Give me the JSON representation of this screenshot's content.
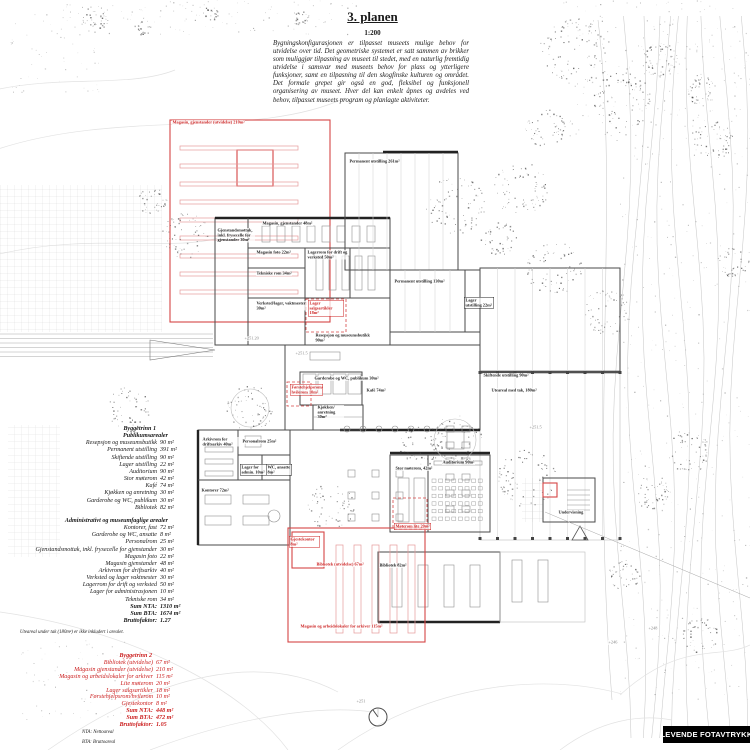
{
  "header": {
    "title": "3. planen",
    "scale": "1:200",
    "description": "Bygningskonfigurasjonen er tilpasset museets mulige behov for utvidelse over tid. Det geometriske systemet er satt sammen av brikker som muliggjør tilpasning av museet til stedet, med en naturlig fremtidig utvidelse i samsvar med museets behov for plass og ytterligere funksjoner, samt en tilpasning til den skogfinske kulturen og området. Det formale grepet gir også en god, fleksibel og funksjonell organisering av museet. Hver del kan enkelt åpnes og avdeles ved behov, tilpasset museets program og planlagte aktiviteter."
  },
  "program": {
    "phase1": {
      "title": "Byggetrinn 1",
      "sections": [
        {
          "heading": "Publikumsarealer",
          "items": [
            {
              "label": "Resepsjon og museumsbutikk",
              "area": "90 m²"
            },
            {
              "label": "Permanent utstilling",
              "area": "391 m²"
            },
            {
              "label": "Skiftende utstilling",
              "area": "90 m²"
            },
            {
              "label": "Lager utstilling",
              "area": "22 m²"
            },
            {
              "label": "Auditorium",
              "area": "90 m²"
            },
            {
              "label": "Stor møterom",
              "area": "42 m²"
            },
            {
              "label": "Kafé",
              "area": "74 m²"
            },
            {
              "label": "Kjøkken og anretning",
              "area": "30 m²"
            },
            {
              "label": "Garderobe og WC, publikum",
              "area": "30 m²"
            },
            {
              "label": "Bibliotek",
              "area": "82 m²"
            }
          ]
        },
        {
          "heading": "Administrativt og museumfaglige arealer",
          "items": [
            {
              "label": "Kontorer, fast",
              "area": "72 m²"
            },
            {
              "label": "Garderobe og WC, ansatte",
              "area": "8 m²"
            },
            {
              "label": "Personalrom",
              "area": "25 m²"
            },
            {
              "label": "Gjenstandsmottak, inkl. frysecelle for gjenstander",
              "area": "30 m²"
            },
            {
              "label": "Magasin foto",
              "area": "22 m²"
            },
            {
              "label": "Magasin gjenstander",
              "area": "48 m²"
            },
            {
              "label": "Arkivrom for driftsarkiv",
              "area": "40 m²"
            },
            {
              "label": "Verksted og lager vaktmester",
              "area": "30 m²"
            },
            {
              "label": "Lagerrom for drift og verksted",
              "area": "50 m²"
            },
            {
              "label": "Lager for administrasjonen",
              "area": "10 m²"
            },
            {
              "label": "Tekniske rom",
              "area": "34 m²"
            }
          ]
        }
      ],
      "totals": [
        {
          "label": "Sum NTA:",
          "area": "1310 m²"
        },
        {
          "label": "Sum BTA:",
          "area": "1674 m²"
        },
        {
          "label": "Bruttofaktor:",
          "area": "1.27"
        }
      ],
      "note": "Uteareal under tak (180m²) er ikke inkludert i arealet."
    },
    "phase2": {
      "title": "Byggetrinn 2",
      "items": [
        {
          "label": "Bibliotek (utvidelse)",
          "area": "67 m²"
        },
        {
          "label": "Magasin gjenstander (utvidelse)",
          "area": "210 m²"
        },
        {
          "label": "Magasin og arbeidslokaler for arkiver",
          "area": "115 m²"
        },
        {
          "label": "Lite møterom",
          "area": "20 m²"
        },
        {
          "label": "Lager salgsartikler",
          "area": "18 m²"
        },
        {
          "label": "Førstehjelpsrom/hvilerom",
          "area": "10 m²"
        },
        {
          "label": "Gjestekontor",
          "area": "8 m²"
        }
      ],
      "totals": [
        {
          "label": "Sum NTA:",
          "area": "448 m²"
        },
        {
          "label": "Sum BTA:",
          "area": "472 m²"
        },
        {
          "label": "Bruttofaktor:",
          "area": "1.05"
        }
      ]
    },
    "abbreviations": [
      "NTA: Nettoareal",
      "BTA: Bruttoareal"
    ]
  },
  "plan": {
    "labels": [
      {
        "t": "Magasin, gjenstander (utvidelse)  210m²",
        "x": 172,
        "y": 120,
        "c": "r"
      },
      {
        "t": "Permanent utstilling  261m²",
        "x": 349,
        "y": 159,
        "c": "k"
      },
      {
        "t": "Magasin, gjenstander  48m²",
        "x": 262,
        "y": 221,
        "c": "k"
      },
      {
        "t": "Gjenstandsmottak, inkl. frysecelle for gjenstander  30m²",
        "x": 217,
        "y": 228,
        "c": "k",
        "w": 37
      },
      {
        "t": "Magasin foto  22m²",
        "x": 256,
        "y": 250,
        "c": "k"
      },
      {
        "t": "Lagerrom for drift og verksted  50m²",
        "x": 307,
        "y": 250,
        "c": "k",
        "w": 40
      },
      {
        "t": "Tekniske rom  34m²",
        "x": 256,
        "y": 271,
        "c": "k"
      },
      {
        "t": "Verksted/lager, vaktmester  30m²",
        "x": 256,
        "y": 301,
        "c": "k",
        "w": 56
      },
      {
        "t": "Lager salgsartikler  18m²",
        "x": 308,
        "y": 300,
        "c": "r",
        "w": 33,
        "box": true
      },
      {
        "t": "Permanent utstilling  130m²",
        "x": 394,
        "y": 279,
        "c": "k"
      },
      {
        "t": "Lager utstilling  22m²",
        "x": 464,
        "y": 297,
        "c": "k",
        "w": 27,
        "box": true
      },
      {
        "t": "+251.20",
        "x": 244,
        "y": 336,
        "c": "g"
      },
      {
        "t": "Resepsjon og museumsbutikk  90m²",
        "x": 315,
        "y": 333,
        "c": "k",
        "w": 55
      },
      {
        "t": "+251.5",
        "x": 295,
        "y": 351,
        "c": "g"
      },
      {
        "t": "Garderobe og WC, publikum  30m²",
        "x": 314,
        "y": 376,
        "c": "k"
      },
      {
        "t": "Førstehjelpsrom/ hvilerom  10m²",
        "x": 290,
        "y": 384,
        "c": "r",
        "w": 30,
        "box": true
      },
      {
        "t": "Kafé  74m²",
        "x": 366,
        "y": 388,
        "c": "k"
      },
      {
        "t": "Kjøkken/ anretning  30m²",
        "x": 317,
        "y": 405,
        "c": "k",
        "w": 26
      },
      {
        "t": "Skiftende utstilling  90m²",
        "x": 483,
        "y": 373,
        "c": "k"
      },
      {
        "t": "Uteareal med tak, 180m²",
        "x": 491,
        "y": 388,
        "c": "k"
      },
      {
        "t": "+251.5",
        "x": 529,
        "y": 425,
        "c": "g"
      },
      {
        "t": "Arkivrom for driftsarkiv  40m²",
        "x": 202,
        "y": 437,
        "c": "k",
        "w": 42
      },
      {
        "t": "Personalrom  25m²",
        "x": 242,
        "y": 439,
        "c": "k",
        "w": 40
      },
      {
        "t": "Lager for admin.  10m²",
        "x": 240,
        "y": 464,
        "c": "k",
        "w": 29,
        "box": true
      },
      {
        "t": "WC, ansatte  8m²",
        "x": 266,
        "y": 464,
        "c": "k",
        "w": 23,
        "box": true
      },
      {
        "t": "Kontorer  72m²",
        "x": 201,
        "y": 488,
        "c": "k"
      },
      {
        "t": "Stor møterom,  42m²",
        "x": 395,
        "y": 466,
        "c": "k",
        "w": 38
      },
      {
        "t": "Auditorium  90m²",
        "x": 442,
        "y": 460,
        "c": "k"
      },
      {
        "t": "Møterom lite  20m²",
        "x": 394,
        "y": 523,
        "c": "r",
        "box": true
      },
      {
        "t": "Gjestekontor  8m²",
        "x": 289,
        "y": 536,
        "c": "r",
        "w": 28,
        "box": true
      },
      {
        "t": "Bibliotek (utvidelse)  67m²",
        "x": 316,
        "y": 562,
        "c": "r"
      },
      {
        "t": "Bibliotek  82m²",
        "x": 379,
        "y": 563,
        "c": "k"
      },
      {
        "t": "Undervisning",
        "x": 558,
        "y": 510,
        "c": "k"
      },
      {
        "t": "Magasin og arbeidslokaler for arkiver  115m²",
        "x": 300,
        "y": 624,
        "c": "r"
      },
      {
        "t": "+248",
        "x": 648,
        "y": 626,
        "c": "g"
      },
      {
        "t": "+246",
        "x": 608,
        "y": 640,
        "c": "g"
      },
      {
        "t": "+251",
        "x": 356,
        "y": 699,
        "c": "g"
      }
    ]
  },
  "footer": {
    "logo": "LEVENDE FOTAVTRYKK"
  }
}
